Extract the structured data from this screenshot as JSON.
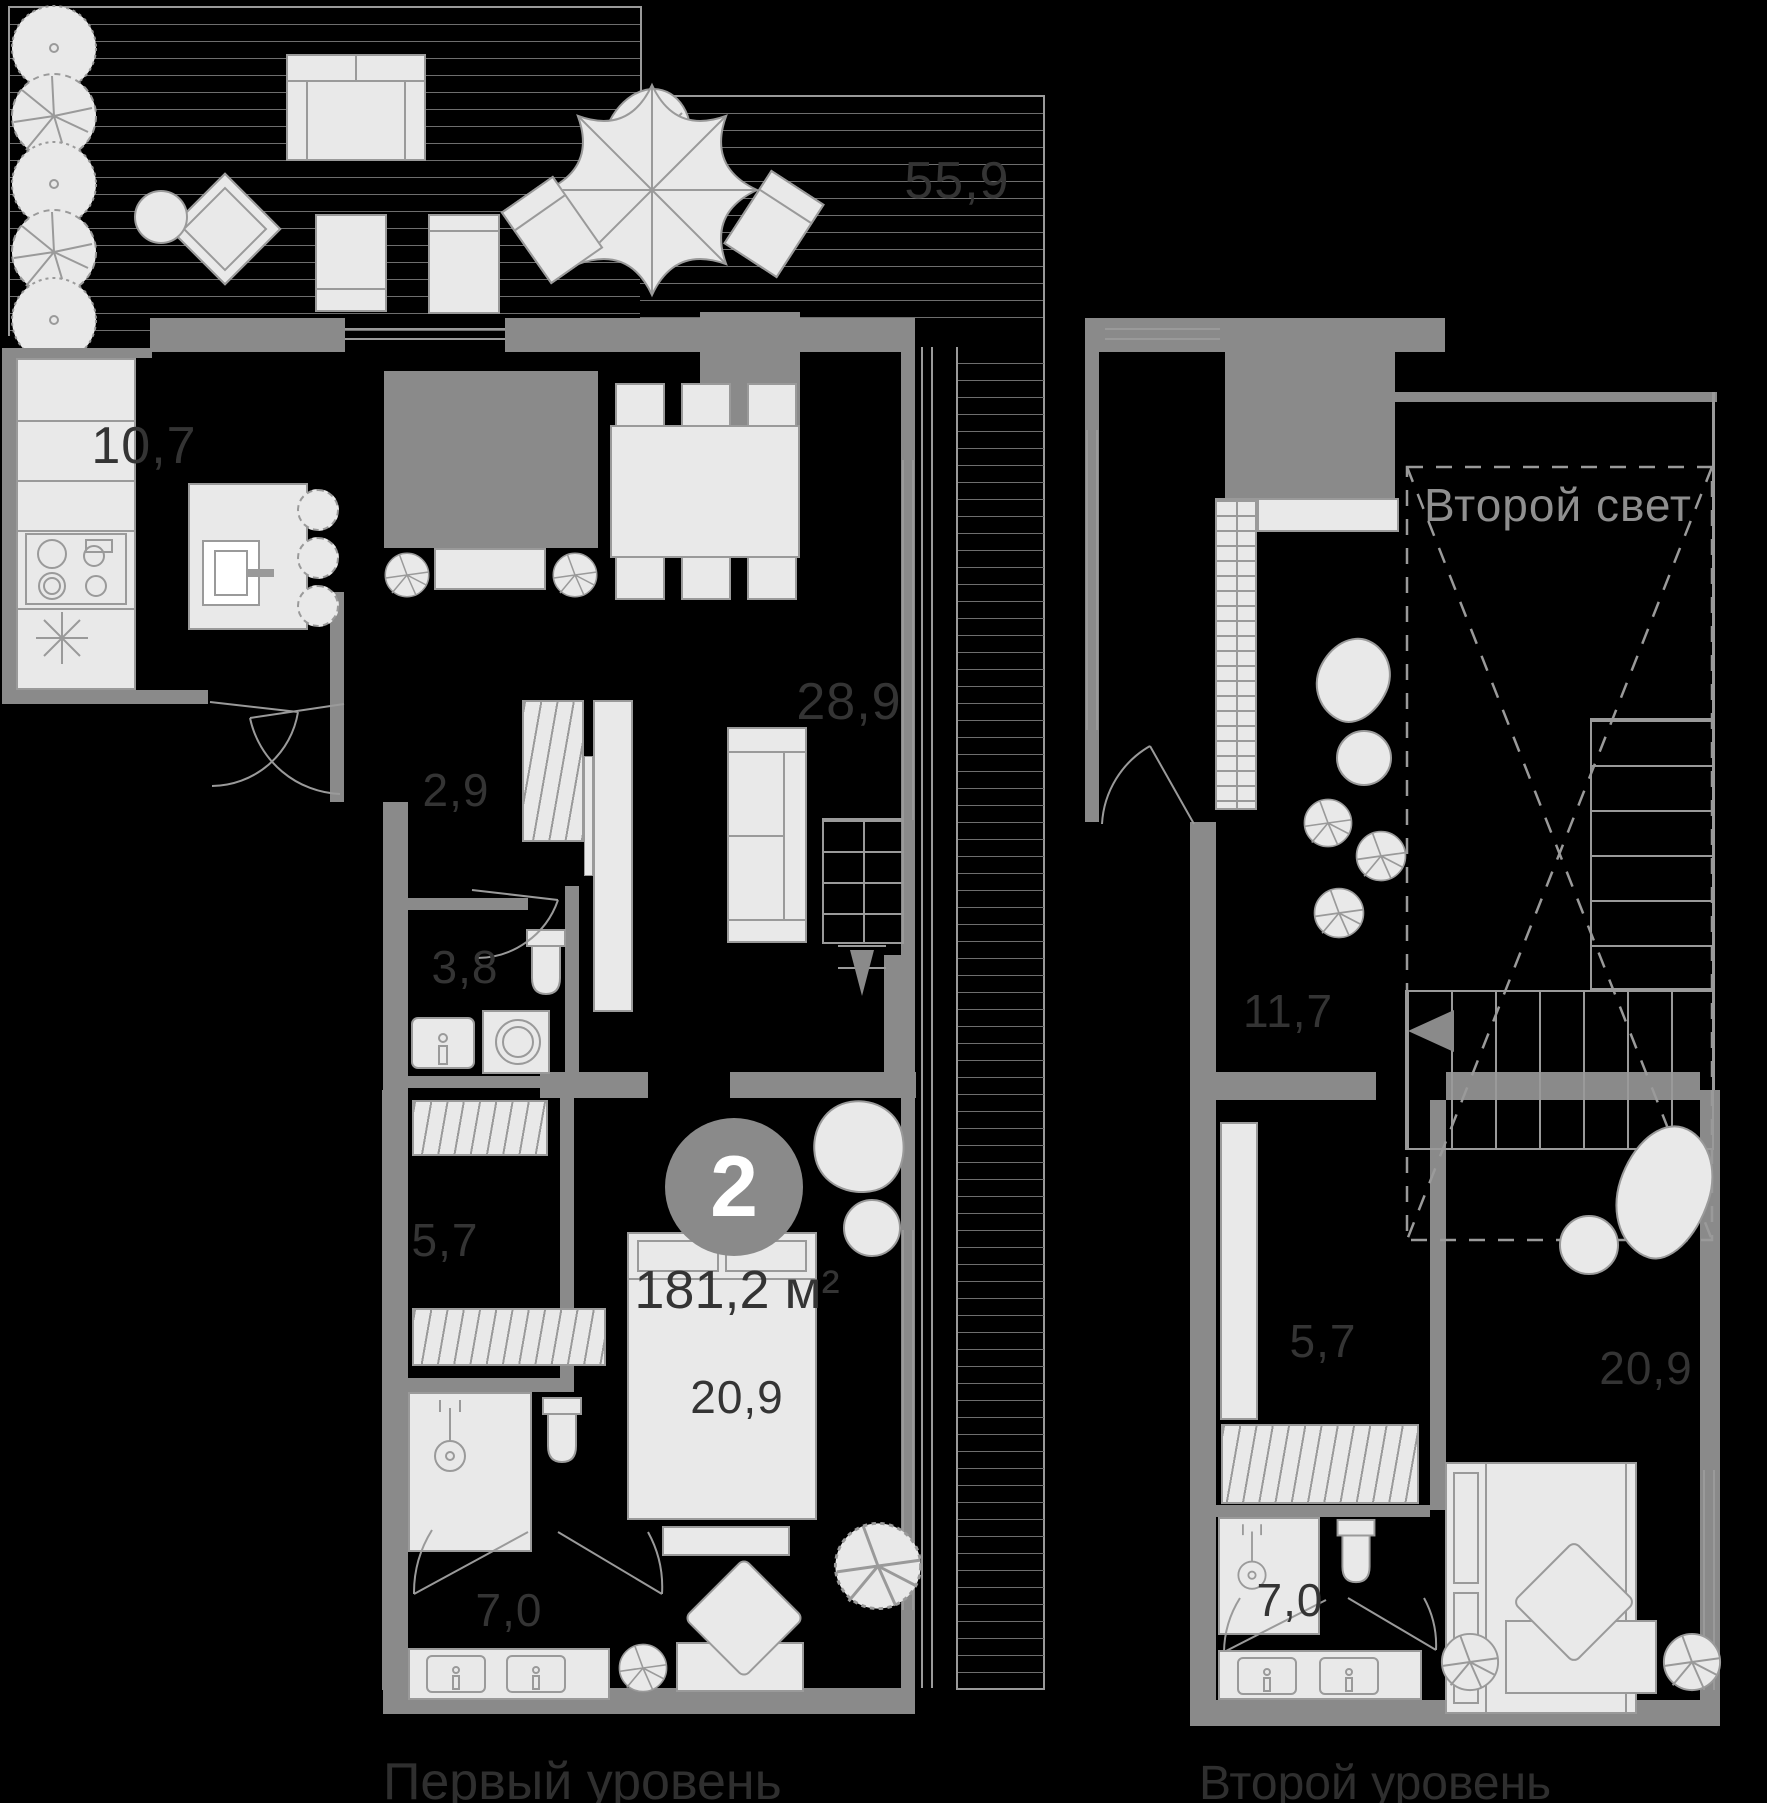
{
  "plan": {
    "unit_badge": {
      "rooms_count": "2",
      "total_area": "181,2 м²"
    },
    "levels": {
      "first": {
        "caption": "Первый уровень",
        "areas": {
          "terrace": "55,9",
          "kitchen": "10,7",
          "living_room": "28,9",
          "hallway": "2,9",
          "bathroom_small": "3,8",
          "wardrobe": "5,7",
          "bedroom": "20,9",
          "bathroom": "7,0"
        }
      },
      "second": {
        "caption": "Второй уровень",
        "void_label": "Второй свет",
        "areas": {
          "hall": "11,7",
          "wardrobe": "5,7",
          "bedroom": "20,9",
          "bathroom": "7,0"
        }
      }
    },
    "colors": {
      "background": "#000000",
      "walls": "#8a8a8a",
      "furniture_fill": "#e9e9e9",
      "furniture_stroke": "#9a9a9a",
      "hatch_line": "#6e6e6e",
      "label_text": "#343434",
      "caption_text": "#2f2f2f",
      "void_text": "#8f8f8f",
      "badge_fill": "#8a8a8a",
      "badge_text": "#ffffff",
      "window_line": "#9a9a9a"
    }
  }
}
